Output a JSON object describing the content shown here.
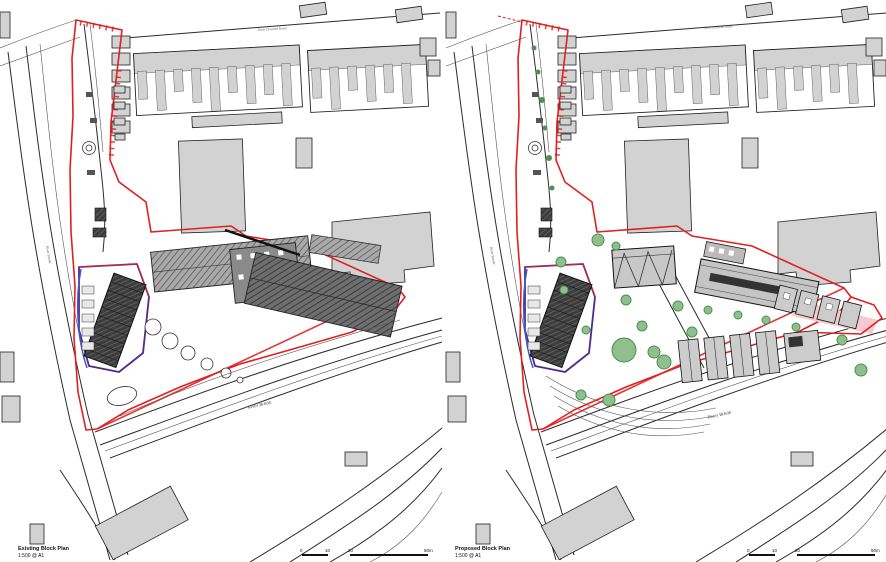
{
  "colors": {
    "boundary-red": "#e02020",
    "parcel-purple": "#4d2a8c",
    "edge-blue": "#3c5cc5",
    "tree-fill": "#8fbe8f",
    "tree-stroke": "#4f8f52",
    "building-fill": "#d2d2d2",
    "line-dark": "#2b2b2b"
  },
  "plans": [
    {
      "title": "Existing Block Plan",
      "scale_note": "1:500 @ A1"
    },
    {
      "title": "Proposed Block Plan",
      "scale_note": "1:500 @ A1"
    }
  ],
  "labels": {
    "top_road": "Rock Channel Road",
    "river_bottom": "River Brede",
    "river_left": "River Brede"
  },
  "scale_bar": {
    "ticks": [
      "0",
      "10",
      "20",
      "50m"
    ]
  }
}
